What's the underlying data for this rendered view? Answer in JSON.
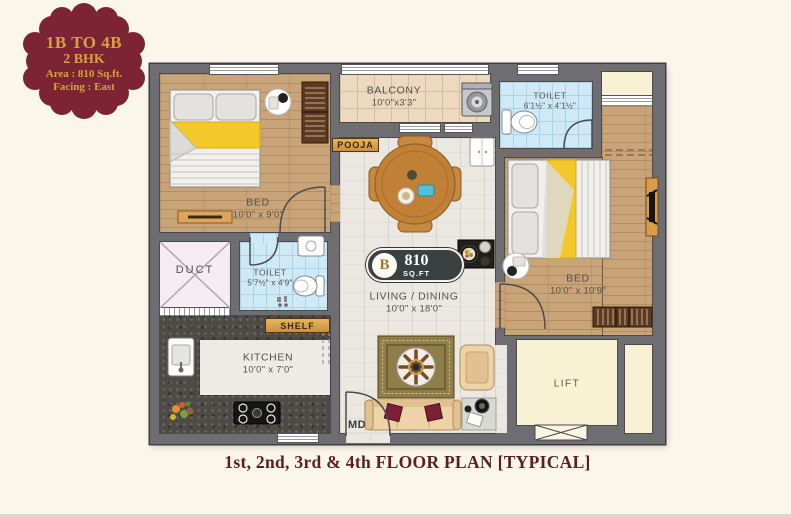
{
  "medallion": {
    "line1": "1B TO 4B",
    "line2": "2 BHK",
    "line3": "Area : 810 Sq.ft.",
    "line4": "Facing : East"
  },
  "unit_marker": {
    "letter": "B",
    "area": "810",
    "unit": "SQ.FT"
  },
  "caption": "1st, 2nd, 3rd & 4th FLOOR PLAN [TYPICAL]",
  "rooms": {
    "bed1": {
      "name": "BED",
      "dims": "10'0\" x 9'0\""
    },
    "balcony": {
      "name": "BALCONY",
      "dims": "10'0\"x3'3\""
    },
    "pooja": {
      "name": "POOJA"
    },
    "toilet_top": {
      "name": "TOILET",
      "dims": "6'1½\" x 4'1½\""
    },
    "bed2": {
      "name": "BED",
      "dims": "10'0\" x 10'9\""
    },
    "duct": {
      "name": "DUCT"
    },
    "toilet_mid": {
      "name": "TOILET",
      "dims": "5'7½\" x 4'9\""
    },
    "shelf": {
      "name": "SHELF"
    },
    "kitchen": {
      "name": "KITCHEN",
      "dims": "10'0\" x 7'0\""
    },
    "living": {
      "name": "LIVING / DINING",
      "dims": "10'0\" x 18'0\""
    },
    "lift": {
      "name": "LIFT"
    },
    "main_door": {
      "name": "MD"
    }
  },
  "colors": {
    "background": "#fbf6ea",
    "medallion": "#7c2433",
    "gold_text": "#d9a23e",
    "caption": "#5c1d24",
    "wall": "#6e6d72",
    "wood_floor": "#c9a478",
    "living_floor": "#eae8e1",
    "toilet_tile": "#cfe9f7",
    "balcony_tile": "#ecd9c0",
    "lift_cream": "#f8f1d4",
    "blanket_yellow": "#f2c82b",
    "badge_dark": "#3b4141"
  }
}
